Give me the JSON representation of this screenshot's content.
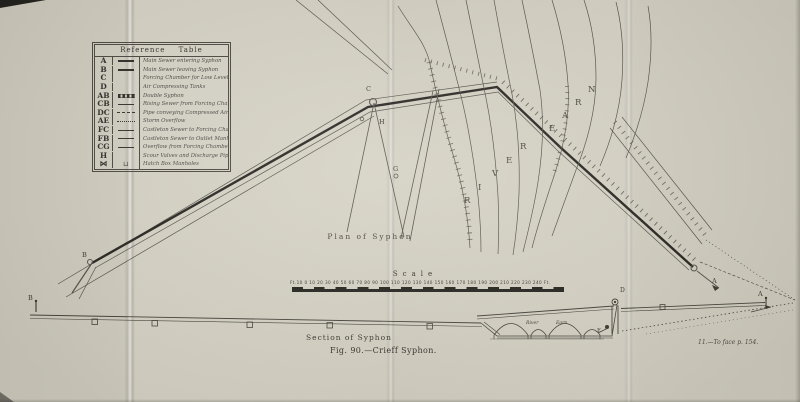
{
  "titles": {
    "plan": "Plan of Syphon",
    "section": "Section of Syphon",
    "figure": "Fig. 90.—Crieff Syphon.",
    "note": "11.—To face p. 154.",
    "scale": "Scale",
    "scale_ticks": "Ft.10 0 10 20 30 40 50 60 70 80 90 100 110 120 130 140 150 160 170 180 190 200 210 220 230 240 Ft."
  },
  "river": {
    "word1": "RIVER",
    "word2": "EARN"
  },
  "reference_table": {
    "title": "Reference Table",
    "rows": [
      {
        "key": "A",
        "line": "thick",
        "glyph": "",
        "desc": "Main Sewer entering Syphon"
      },
      {
        "key": "B",
        "line": "thick",
        "glyph": "",
        "desc": "Main Sewer leaving Syphon"
      },
      {
        "key": "C",
        "line": "none",
        "glyph": "",
        "desc": "Forcing Chamber for Low Level Sewage"
      },
      {
        "key": "D",
        "line": "none",
        "glyph": "",
        "desc": "Air Compressing Tanks"
      },
      {
        "key": "AB",
        "line": "banded",
        "glyph": "",
        "desc": "Double Syphon"
      },
      {
        "key": "CB",
        "line": "solid",
        "glyph": "",
        "desc": "Rising Sewer from Forcing Chamber"
      },
      {
        "key": "DC",
        "line": "dashed",
        "glyph": "",
        "desc": "Pipe conveying Compressed Air"
      },
      {
        "key": "AE",
        "line": "dotted",
        "glyph": "",
        "desc": "Storm Overflow"
      },
      {
        "key": "FC",
        "line": "solid",
        "glyph": "",
        "desc": "Castleton Sewer to Forcing Chamber"
      },
      {
        "key": "FB",
        "line": "solid",
        "glyph": "",
        "desc": "Castleton Sewer to Outlet Manhole"
      },
      {
        "key": "CG",
        "line": "solid",
        "glyph": "",
        "desc": "Overflow from Forcing Chamber"
      },
      {
        "key": "H",
        "line": "none",
        "glyph": "",
        "desc": "Scour Valves and Discharge Pipes"
      },
      {
        "key": "⋈",
        "line": "glyph",
        "glyph": "⊔",
        "desc": "Hatch Box Manholes"
      }
    ]
  },
  "plan_labels": {
    "b": "B",
    "c": "C",
    "h": "H",
    "g": "G",
    "a": "A"
  },
  "section_labels": {
    "b": "B",
    "a": "A",
    "d": "D",
    "e": "E",
    "river": "River",
    "earn": "Earn"
  },
  "colors": {
    "paper": "#d3d0c2",
    "ink": "#3e3c33",
    "sewer": "#26241f"
  }
}
